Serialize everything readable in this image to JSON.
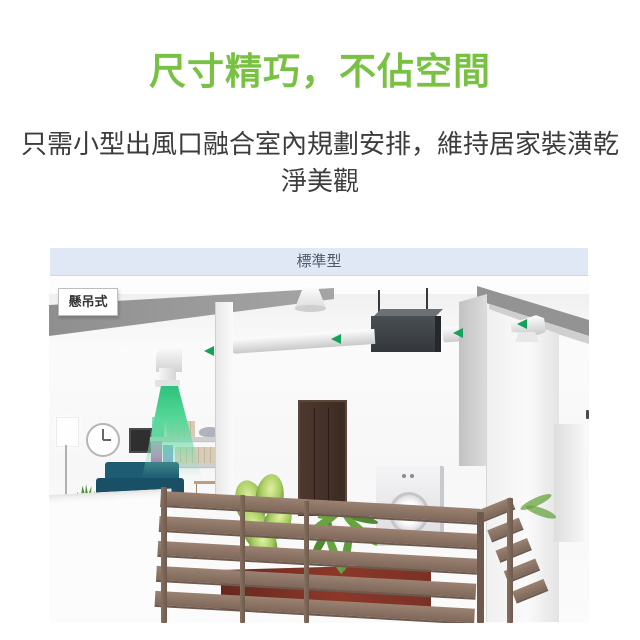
{
  "heading": {
    "text": "尺寸精巧，不佔空間"
  },
  "subtitle": {
    "text": "只需小型出風口融合室內規劃安排，維持居家裝潢乾淨美觀"
  },
  "banner": {
    "label": "標準型"
  },
  "scene": {
    "mount_tag": "懸吊式"
  },
  "colors": {
    "accent_green": "#79c143",
    "banner_bg": "#dfe8f4",
    "banner_text": "#4d5a6a",
    "airflow_green": "#2fbf78",
    "arrow_green": "#13a257",
    "fence_brown": "#8b7262",
    "sofa_teal": "#1c5a72"
  }
}
